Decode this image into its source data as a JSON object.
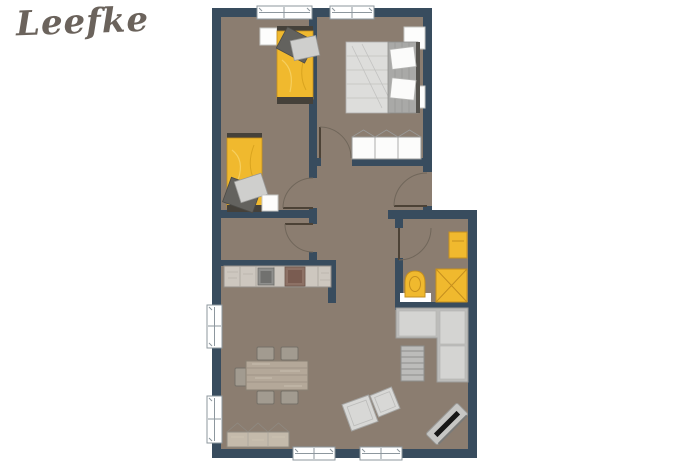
{
  "logo": {
    "text": "Leefke"
  },
  "colors": {
    "c-wall": "#384c5e",
    "c-floor": "#8b7d70",
    "c-accent": "#f0b92e",
    "c-accent-border": "#c58f1e",
    "c-white": "#ffffff",
    "c-gray-furn": "#bcbcba",
    "c-gray-light": "#d4d4d2",
    "c-wood": "#c4baab",
    "c-logo": "#6b635c"
  },
  "floorplan": {
    "type": "apartment-floor-plan",
    "rooms": [
      {
        "id": "bedroom-twin",
        "items": [
          "single-bed",
          "single-bed",
          "nightstand",
          "nightstand"
        ]
      },
      {
        "id": "bedroom-master",
        "items": [
          "double-bed",
          "nightstand",
          "nightstand",
          "sliding-wardrobe"
        ]
      },
      {
        "id": "hallway",
        "items": []
      },
      {
        "id": "corridor-niche",
        "items": []
      },
      {
        "id": "bathroom",
        "items": [
          "washbasin",
          "toilet",
          "shower"
        ]
      },
      {
        "id": "kitchen",
        "items": [
          "counter",
          "sink",
          "stove"
        ]
      },
      {
        "id": "living-dining",
        "items": [
          "dining-table",
          "chair",
          "chair",
          "chair",
          "chair",
          "chair",
          "sideboard",
          "corner-sofa",
          "slatted-side-table",
          "pouf",
          "pouf",
          "tv-on-stand"
        ]
      }
    ],
    "window_count": 6,
    "door_swing_count": 5
  }
}
